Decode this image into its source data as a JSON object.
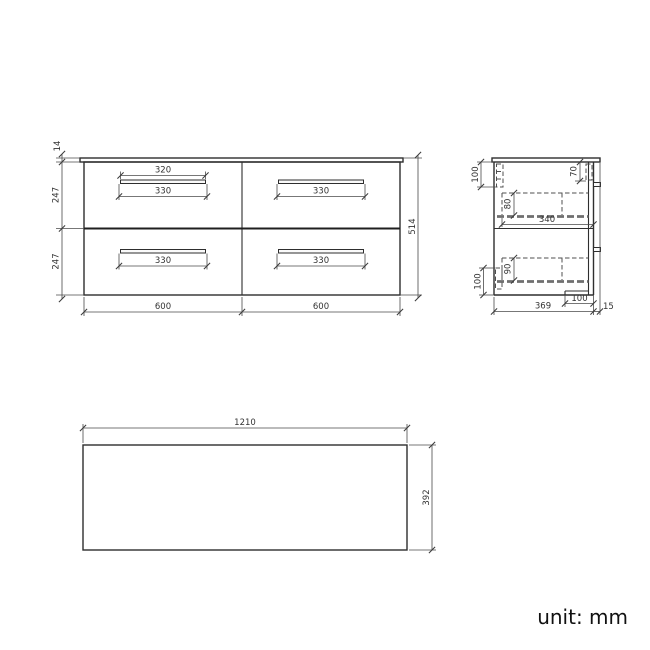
{
  "unit_label": "unit: mm",
  "colors": {
    "line": "#2e2e2e",
    "dim_line": "#4a4a4a",
    "hidden_line": "#6f6f6f",
    "text": "#333333",
    "background": "#ffffff"
  },
  "front_view": {
    "worktop_thickness": "14",
    "upper_drawer_height": "247",
    "lower_drawer_height": "247",
    "total_height": "514",
    "left_section_width": "600",
    "right_section_width": "600",
    "handle_width": "320",
    "recess_top_left": "330",
    "recess_top_right": "330",
    "recess_bottom_left": "330",
    "recess_bottom_right": "330"
  },
  "side_view": {
    "top_bracket_height": "100",
    "front_top_inset": "70",
    "upper_drawer_side_height": "80",
    "drawer_depth": "340",
    "lower_drawer_side_height": "90",
    "bottom_bracket_height": "100",
    "base_recess_depth": "100",
    "body_depth": "369",
    "worktop_overhang": "15"
  },
  "plan_view": {
    "width": "1210",
    "depth": "392"
  }
}
